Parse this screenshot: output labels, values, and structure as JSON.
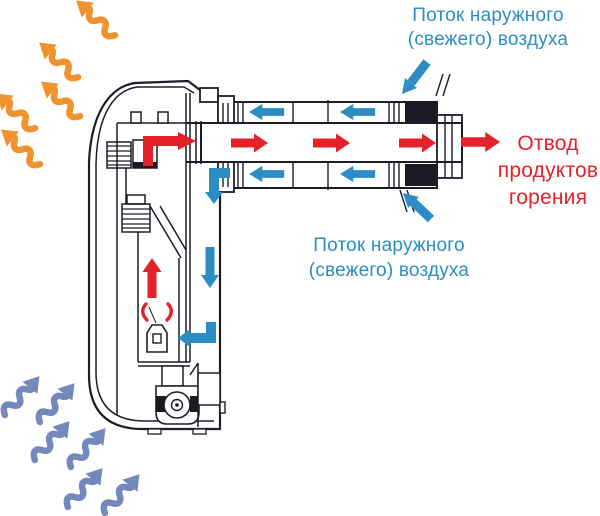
{
  "diagram": {
    "type": "technical-airflow-diagram",
    "labels": {
      "fresh_air_top": {
        "line1": "Поток наружного",
        "line2": "(свежего) воздуха"
      },
      "exhaust": {
        "line1": "Отвод",
        "line2": "продуктов",
        "line3": "горения"
      },
      "fresh_air_bottom": {
        "line1": "Поток наружного",
        "line2": "(свежего) воздуха"
      }
    },
    "colors": {
      "fresh_air_blue": "#2b8dc4",
      "exhaust_red": "#e3222a",
      "warm_air_orange": "#f0922d",
      "room_air_blue_gray": "#7388bb",
      "line_art": "#1d1d28",
      "seal_black": "#1a1a22",
      "background": "#ffffff"
    },
    "icons": {
      "warm_air_arrow": {
        "name": "wavy-arrow-up-left-icon",
        "count": 5
      },
      "room_air_arrow": {
        "name": "wavy-arrow-up-right-icon",
        "count": 6
      },
      "exhaust_flow_arrow": {
        "name": "red-right-arrow-icon",
        "count": 5
      },
      "fresh_air_flow_arrow": {
        "name": "blue-left-arrow-icon",
        "count": 4
      }
    }
  }
}
